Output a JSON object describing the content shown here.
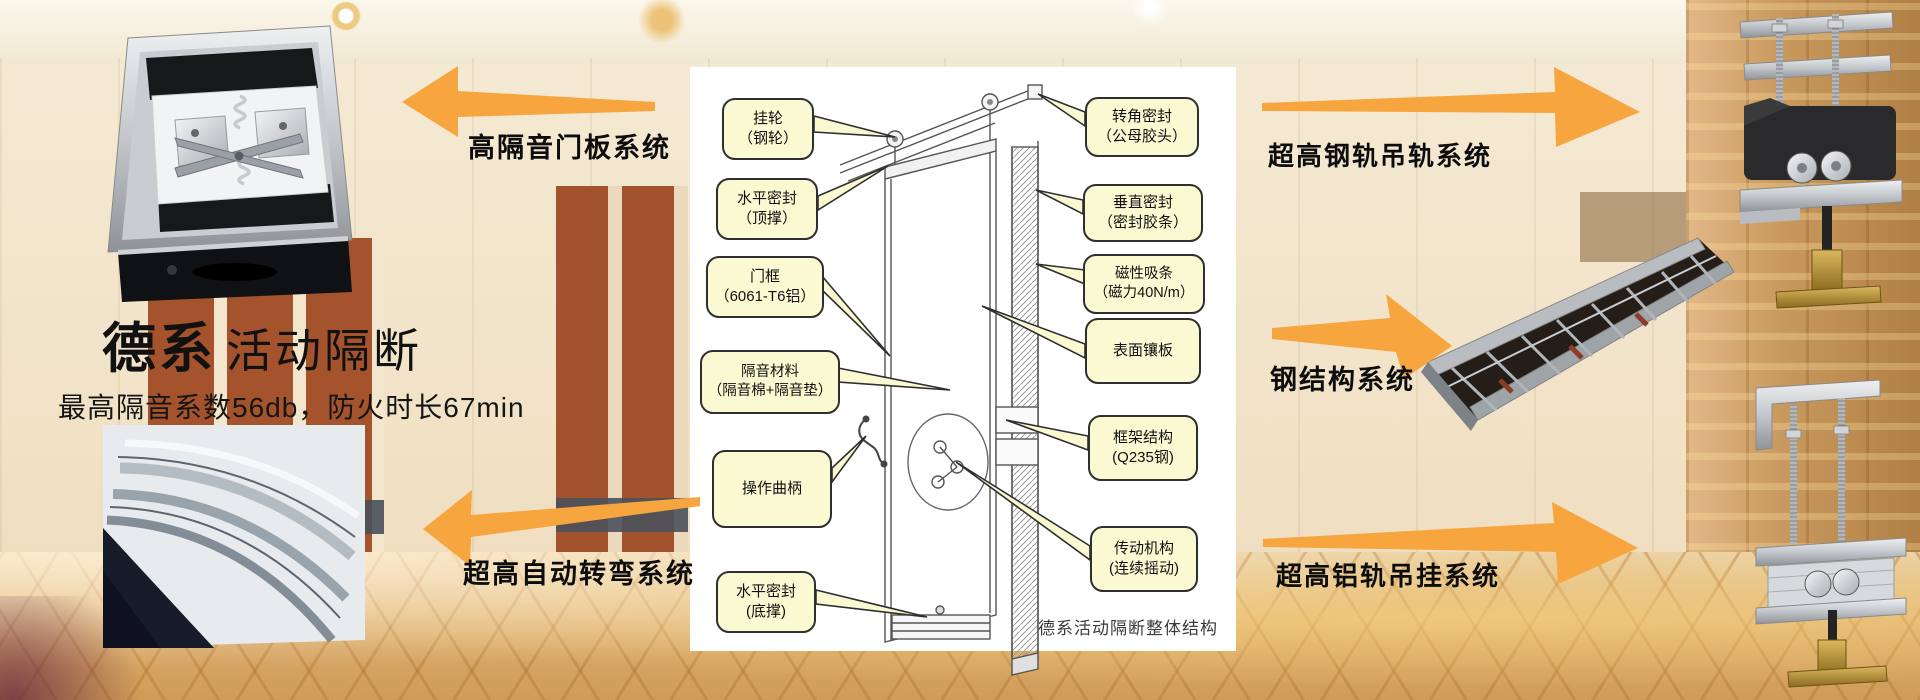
{
  "brand": {
    "title_bold": "德系",
    "title_light": "活动隔断",
    "subtitle": "最高隔音系数56db，防火时长67min"
  },
  "feature_labels": {
    "door_panel": "高隔音门板系统",
    "auto_turn": "超高自动转弯系统",
    "steel_rail": "超高钢轨吊轨系统",
    "steel_structure": "钢结构系统",
    "alu_rail": "超高铝轨吊挂系统"
  },
  "diagram": {
    "caption": "德系活动隔断整体结构",
    "left_callouts": [
      {
        "text": "挂轮\n（钢轮）"
      },
      {
        "text": "水平密封\n（顶撑）"
      },
      {
        "text": "门框\n（6061-T6铝）"
      },
      {
        "text": "隔音材料\n（隔音棉+隔音垫）"
      },
      {
        "text": "操作曲柄"
      },
      {
        "text": "水平密封\n(底撑)"
      }
    ],
    "right_callouts": [
      {
        "text": "转角密封\n（公母胶头）"
      },
      {
        "text": "垂直密封\n（密封胶条）"
      },
      {
        "text": "磁性吸条\n（磁力40N/m）"
      },
      {
        "text": "表面镶板"
      },
      {
        "text": "框架结构\n(Q235钢)"
      },
      {
        "text": "传动机构\n(连续摇动)"
      }
    ]
  },
  "colors": {
    "accent": "#F7A53F",
    "callout_bg": "#FBF9D2",
    "callout_border": "#2F2F2F",
    "panel_bg": "#FFFFFF",
    "carpet": "#DFAE6F"
  }
}
